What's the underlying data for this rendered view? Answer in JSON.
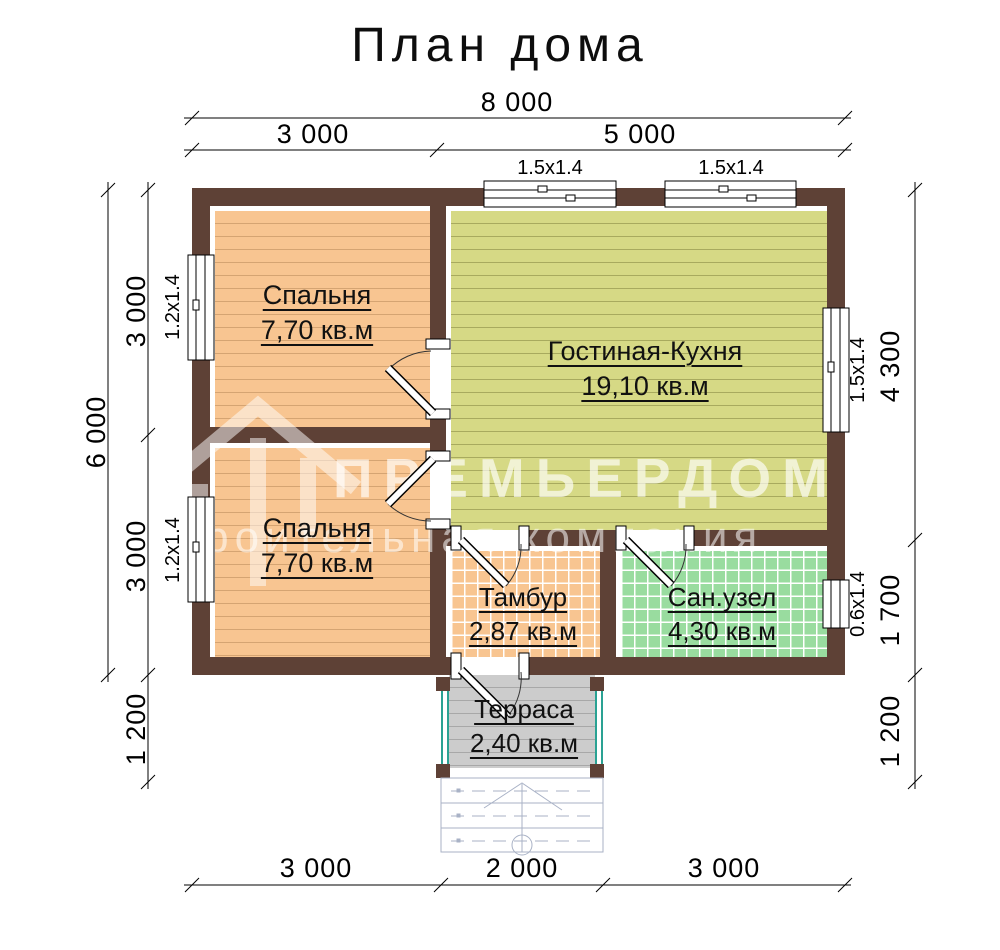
{
  "title": "План дома",
  "watermark": {
    "brand": "ПРЕМЬЕРДОМ",
    "tagline": "строительная компания"
  },
  "rooms": [
    {
      "id": "bedroom-top",
      "name": "Спальня",
      "area": "7,70 кв.м"
    },
    {
      "id": "living",
      "name": "Гостиная-Кухня",
      "area": "19,10 кв.м"
    },
    {
      "id": "bedroom-bottom",
      "name": "Спальня",
      "area": "7,70 кв.м"
    },
    {
      "id": "tambour",
      "name": "Тамбур",
      "area": "2,87 кв.м"
    },
    {
      "id": "bathroom",
      "name": "Сан.узел",
      "area": "4,30 кв.м"
    },
    {
      "id": "terrace",
      "name": "Терраса",
      "area": "2,40 кв.м"
    }
  ],
  "dimensions": {
    "top": {
      "total": "8 000",
      "segments": [
        "3 000",
        "5 000"
      ]
    },
    "left": {
      "total": "6 000",
      "segments": [
        "3 000",
        "3 000",
        "1 200"
      ]
    },
    "right": {
      "segments": [
        "4 300",
        "1 700",
        "1 200"
      ]
    },
    "bottom": {
      "segments": [
        "3 000",
        "2 000",
        "3 000"
      ]
    }
  },
  "windows": {
    "top": [
      "1.5x1.4",
      "1.5x1.4"
    ],
    "left": [
      "1.2x1.4",
      "1.2x1.4"
    ],
    "right": [
      "1.5x1.4",
      "0.6x1.4"
    ]
  },
  "colors": {
    "wall": "#5e4136",
    "bedroom_fill": "#f8c591",
    "bedroom_line": "#d5a472",
    "living_fill": "#d6d985",
    "living_line": "#a8aa5e",
    "bath_fill": "#99dc9f",
    "tambour_fill": "#f8c591",
    "tile_line": "#ffffff",
    "terrace_fill": "#cccccc",
    "terrace_line": "#a8a8a8",
    "railing": "#2aa293",
    "stairs": "#a9b2c6",
    "dim": "#000000",
    "label": "#111111"
  }
}
